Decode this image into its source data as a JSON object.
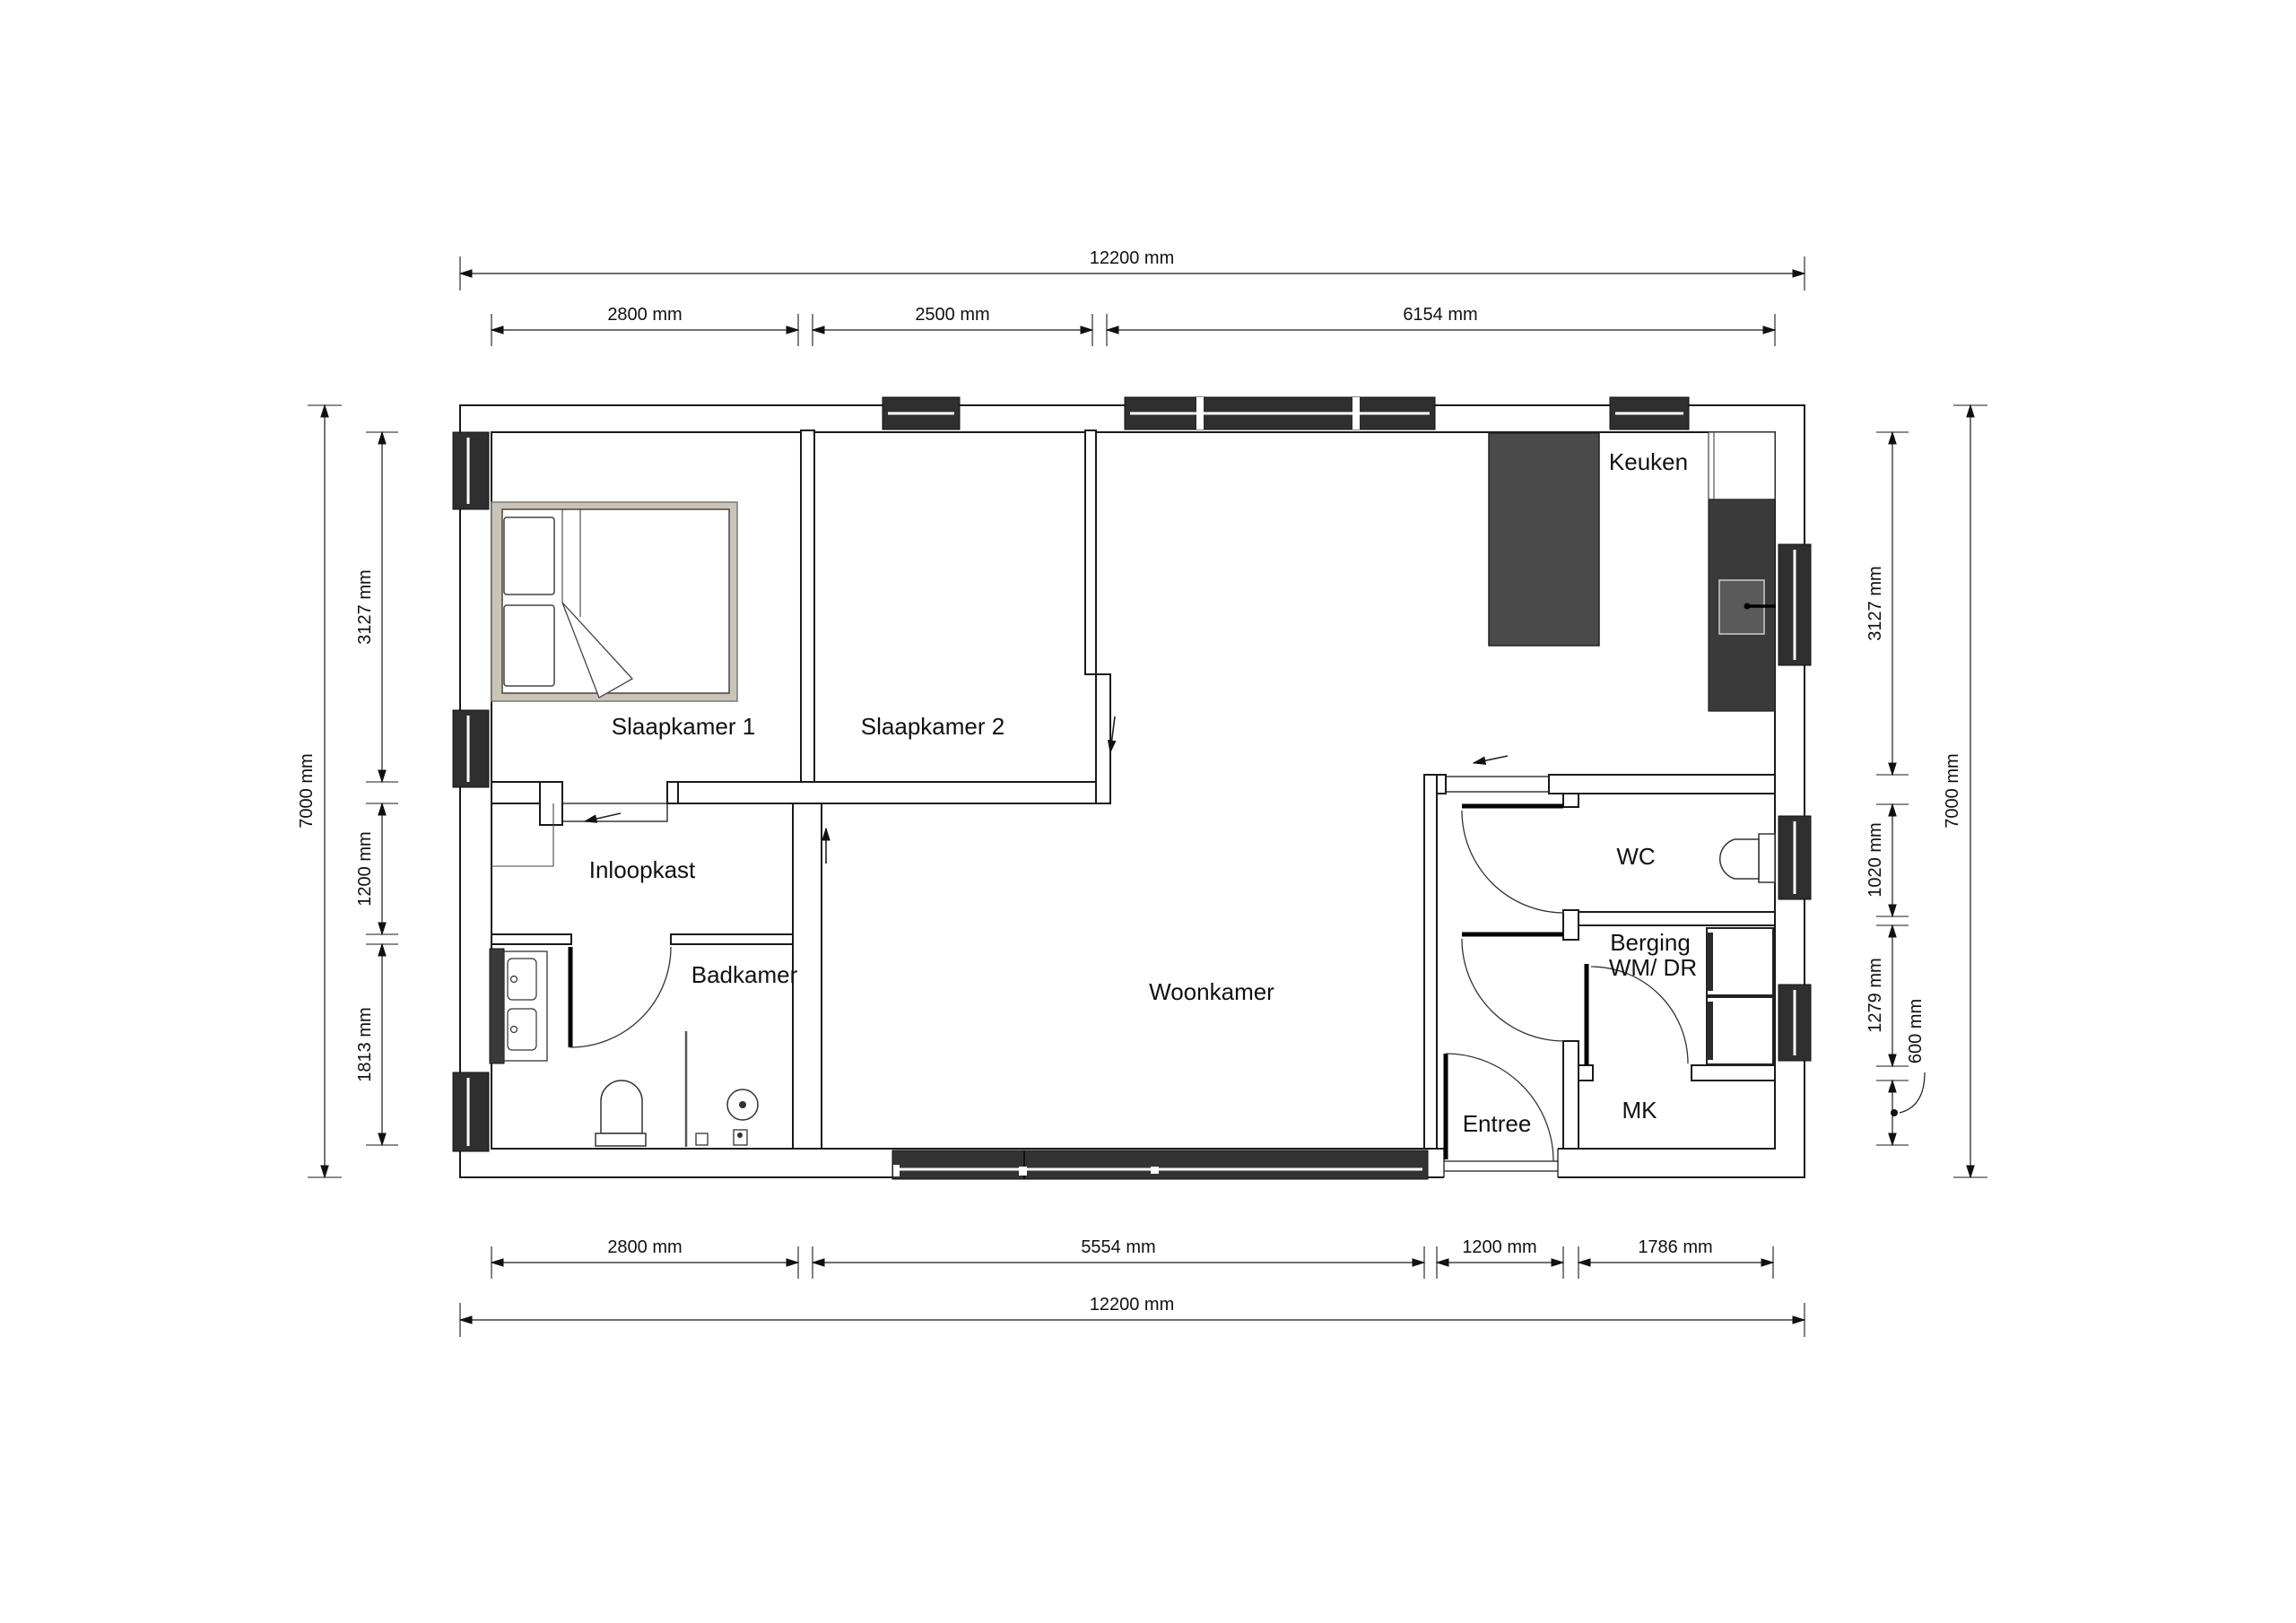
{
  "title": "Plattegrond woning 12200 x 7000",
  "rooms": [
    {
      "id": "slaapkamer-1",
      "label": "Slaapkamer 1"
    },
    {
      "id": "slaapkamer-2",
      "label": "Slaapkamer 2"
    },
    {
      "id": "keuken",
      "label": "Keuken"
    },
    {
      "id": "inloopkast",
      "label": "Inloopkast"
    },
    {
      "id": "badkamer",
      "label": "Badkamer"
    },
    {
      "id": "woonkamer",
      "label": "Woonkamer"
    },
    {
      "id": "wc",
      "label": "WC"
    },
    {
      "id": "berging",
      "label": "Berging",
      "sublabel": "WM/ DR"
    },
    {
      "id": "entree",
      "label": "Entree"
    },
    {
      "id": "mk",
      "label": "MK"
    }
  ],
  "dimensions": {
    "top_overall": "12200 mm",
    "top": [
      "2800 mm",
      "2500 mm",
      "6154 mm"
    ],
    "bottom": [
      "2800 mm",
      "5554 mm",
      "1200 mm",
      "1786 mm"
    ],
    "bottom_overall": "12200 mm",
    "left_overall": "7000 mm",
    "left": [
      "3127 mm",
      "1200 mm",
      "1813 mm"
    ],
    "right": [
      "3127 mm",
      "1020 mm",
      "1279 mm",
      "600 mm"
    ],
    "right_overall": "7000 mm"
  },
  "colors": {
    "window_dark": "#2f2f2f",
    "island": "#4a4a4a",
    "counter": "#3a3a3a",
    "sink": "#5a5a5a",
    "bed_frame": "#cbc3b7",
    "appliance_strip": "#2b2b2b",
    "slider_dark": "#333333"
  }
}
